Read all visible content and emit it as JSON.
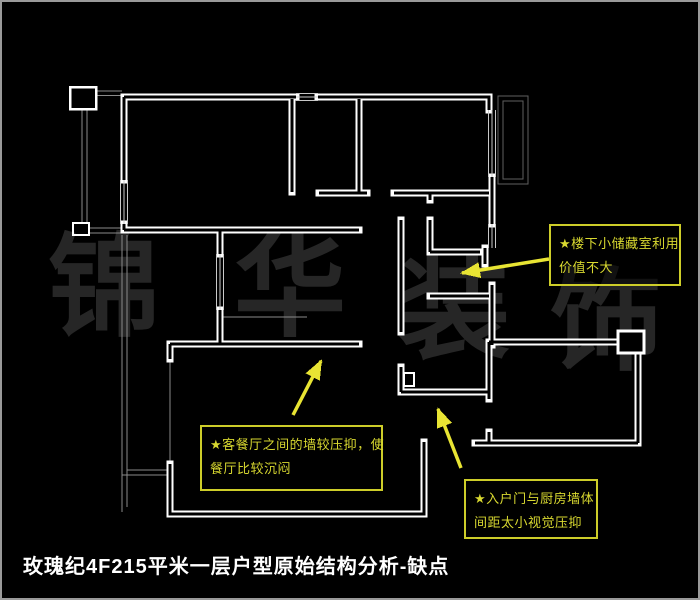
{
  "page": {
    "background": "#000000",
    "frame_border_color": "#9a9a9a"
  },
  "title": {
    "text": "玫瑰纪4F215平米一层户型原始结构分析-缺点",
    "color": "#ffffff"
  },
  "watermark": {
    "text": "锦华装饰",
    "chars": [
      "锦",
      "华",
      "装",
      "饰"
    ],
    "color": "#262626"
  },
  "floor_plan": {
    "wall_color": "#ffffff",
    "window_color": "#c8c8c8",
    "rail_color": "#8a8a8a",
    "balcony_color": "#5f5f5f"
  },
  "annotation_style": {
    "border_color": "#cdcd29",
    "text_color": "#d8d830",
    "arrow_color": "#e8e433"
  },
  "annotations": [
    {
      "id": "storage-room-note",
      "lines": [
        "★楼下小储藏室利用",
        "价值不大"
      ]
    },
    {
      "id": "dining-wall-note",
      "lines": [
        "★客餐厅之间的墙较压抑，使",
        "餐厅比较沉闷"
      ]
    },
    {
      "id": "entry-door-note",
      "lines": [
        "★入户门与厨房墙体",
        "间距太小视觉压抑"
      ]
    }
  ]
}
